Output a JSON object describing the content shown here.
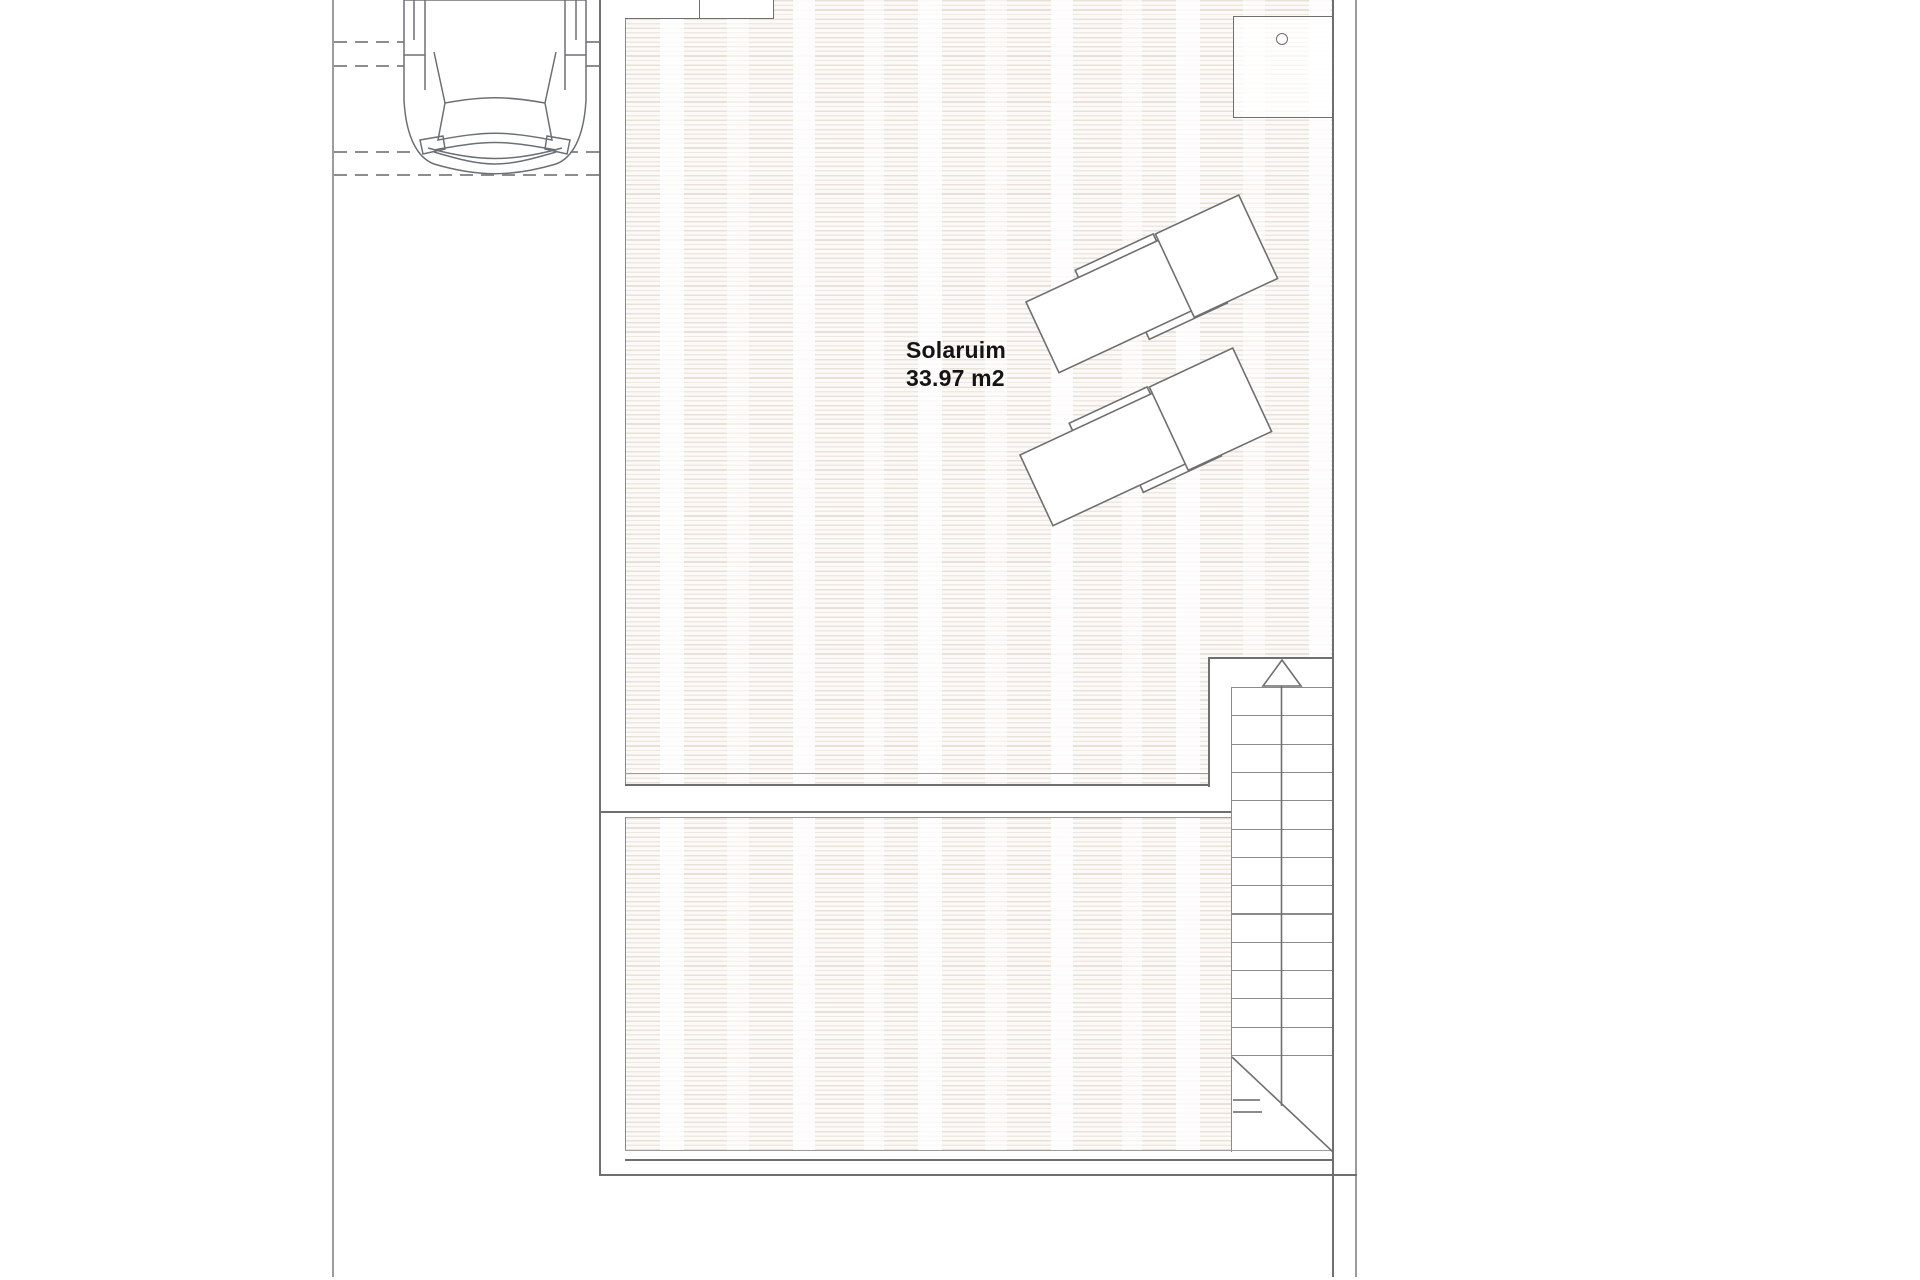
{
  "plan": {
    "room_label": {
      "name": "Solaruim",
      "area": "33.97 m2"
    },
    "stairs": {
      "steps": 14,
      "step_pitch_px": 28.3,
      "direction_arrow": "up"
    },
    "objects": {
      "car": "car-top-view",
      "sun_loungers": 2,
      "shower_circle": "circle-fixture"
    },
    "colors": {
      "line_strong": "#6f6f6f",
      "line_light": "#9c9c9c",
      "deck_stripe": "#e9e1d8",
      "text": "#141414"
    }
  }
}
